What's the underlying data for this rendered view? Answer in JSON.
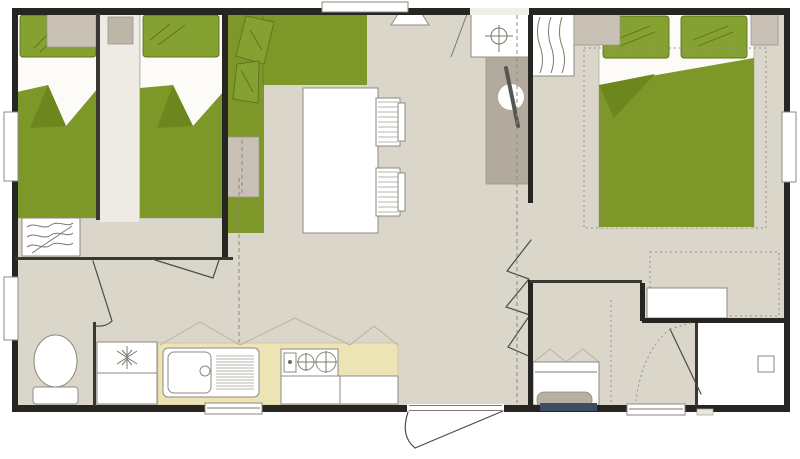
{
  "plan": {
    "type": "mobile-home-floor-plan",
    "width_px": 800,
    "height_px": 459
  },
  "palette": {
    "floor": "#dad6ca",
    "floor_light": "#edebe3",
    "outer_wall": "#262522",
    "inner_wall": "#3a3733",
    "line": "#8d8a82",
    "green": "#7d9729",
    "green_pillow": "#85a132",
    "green_dark": "#5c731c",
    "green_fold": "#6d871f",
    "gray_furniture": "#c9c1b6",
    "taupe": "#b3aa9e",
    "kitchen_counter": "#ece4b4",
    "basin": "#b9afa3",
    "navy_mat": "#3f4d62",
    "white": "#ffffff"
  },
  "rooms": [
    {
      "id": "twin-bedroom",
      "position": "top-left",
      "furniture": [
        "single-bed",
        "single-bed",
        "overhead-shelf",
        "bedside-table",
        "wardrobe",
        "window"
      ]
    },
    {
      "id": "living-area",
      "position": "center-left",
      "furniture": [
        "corner-sofa",
        "sofa-cushions",
        "side-table",
        "dining-table",
        "chair",
        "chair"
      ]
    },
    {
      "id": "entrance-hall",
      "position": "center",
      "furniture": [
        "roof-vent",
        "wall-heater",
        "utility-cabinet",
        "sliding-partition",
        "folding-door",
        "entrance-door"
      ]
    },
    {
      "id": "kitchen",
      "position": "bottom-center-left",
      "furniture": [
        "fridge",
        "sink-with-drainboard",
        "two-burner-hob",
        "base-cabinet",
        "base-cabinet",
        "overhead-cabinets",
        "window"
      ]
    },
    {
      "id": "wc",
      "position": "bottom-left",
      "furniture": [
        "toilet",
        "door"
      ]
    },
    {
      "id": "double-bedroom",
      "position": "right",
      "furniture": [
        "double-bed",
        "bedside-table",
        "bedside-table",
        "wardrobe",
        "storage-bench",
        "window"
      ]
    },
    {
      "id": "washroom",
      "position": "bottom-right-center",
      "furniture": [
        "washbasin",
        "mirror",
        "mat"
      ]
    },
    {
      "id": "shower-room",
      "position": "bottom-right",
      "furniture": [
        "shower-tray",
        "drain",
        "door"
      ]
    }
  ],
  "symbols": [
    "door-swing-arc",
    "bifold-door-lines",
    "accordion-door-zigzag",
    "sliding-partition-dashed-line",
    "roof-vent-crosshair",
    "hanging-clothes-waves",
    "fridge-snowflake",
    "bed-frame-dotted-outline",
    "overhead-cabinet-peaks"
  ]
}
